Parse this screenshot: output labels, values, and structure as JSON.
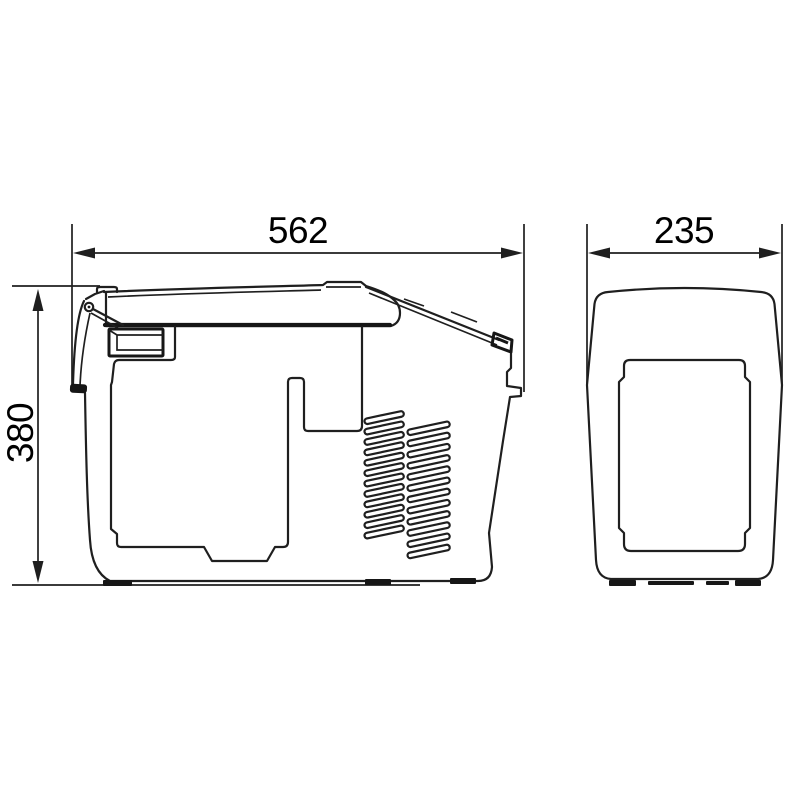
{
  "figure": {
    "kind": "technical dimension drawing",
    "subject": "portable cooler / compressor coolbox, side view and front view",
    "views": [
      {
        "id": "side-view",
        "description": "side elevation with lid, latch and vent grille"
      },
      {
        "id": "front-view",
        "description": "front elevation with recessed panel"
      }
    ]
  },
  "dimensions": {
    "width_label": "562",
    "height_label": "380",
    "depth_label": "235"
  },
  "vent_grille": {
    "columns": 2,
    "slots_per_column": 12
  },
  "colors": {
    "line": "#1f1f1f",
    "dark": "#161616",
    "text": "#000000",
    "background": "#ffffff"
  }
}
